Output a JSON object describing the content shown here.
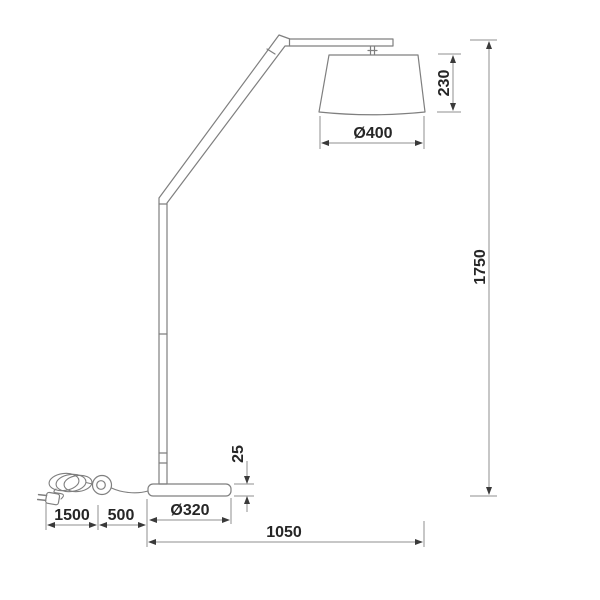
{
  "colors": {
    "bg": "#ffffff",
    "line": "#7f7f7f",
    "dim": "#8f8f8f",
    "arrow": "#3a3a3a",
    "text": "#262626"
  },
  "dimensions": {
    "shade_height": "230",
    "shade_diameter": "Ø400",
    "total_height": "1750",
    "base_thickness": "25",
    "cord_length": "1500",
    "switch_distance": "500",
    "base_diameter": "Ø320",
    "arm_reach": "1050"
  }
}
